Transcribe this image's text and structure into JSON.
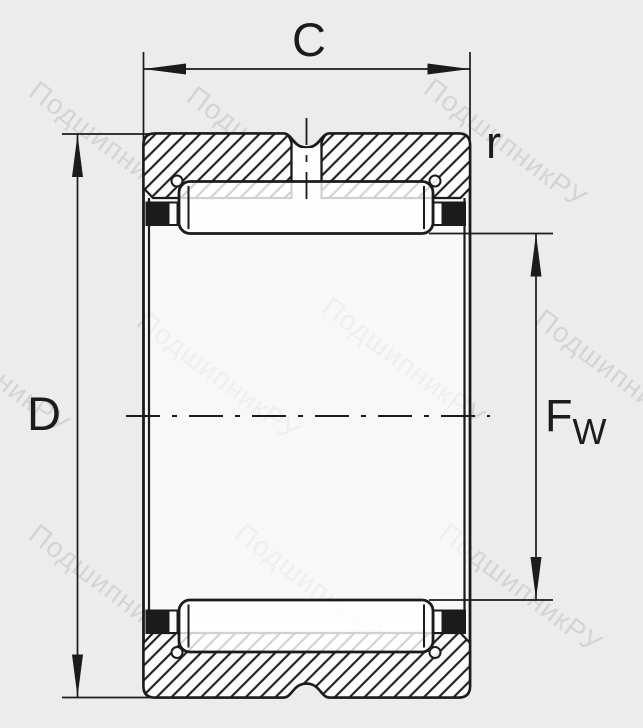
{
  "labels": {
    "width": "C",
    "outer_diameter": "D",
    "corner_radius": "r",
    "bore_main": "F",
    "bore_sub": "W"
  },
  "watermark": {
    "text": "ПодшипникРУ"
  },
  "colors": {
    "background": "#ececec",
    "line": "#1b1b1b",
    "drawing_fill": "#ffffff",
    "seal_fill": "#1b1b1b",
    "watermark": "#c2c2c2"
  }
}
